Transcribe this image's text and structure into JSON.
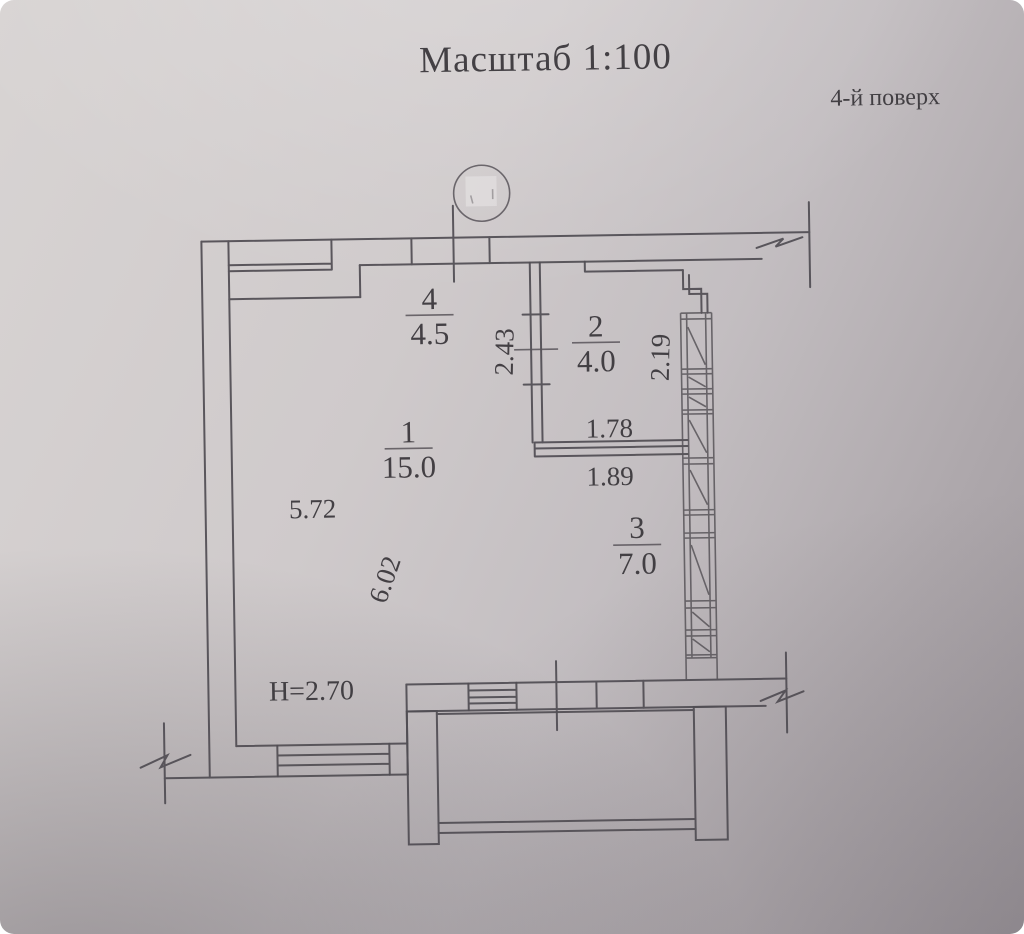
{
  "document": {
    "title": "Масштаб 1:100",
    "floor_label": "4-й поверх",
    "ceiling_height": "H=2.70",
    "drawing_type": "floor-plan"
  },
  "rooms": [
    {
      "number": "1",
      "area": "15.0"
    },
    {
      "number": "2",
      "area": "4.0"
    },
    {
      "number": "3",
      "area": "7.0"
    },
    {
      "number": "4",
      "area": "4.5"
    }
  ],
  "dimensions": {
    "room1_width": "5.72",
    "room1_depth": "6.02",
    "hall_wall_length": "2.43",
    "glazing_length": "2.19",
    "room2_width": "1.78",
    "room3_width": "1.89"
  },
  "colors": {
    "paper_light": "#d8d4d3",
    "paper_dark": "#9d979c",
    "ink": "#504d53",
    "text": "#3b383d"
  }
}
